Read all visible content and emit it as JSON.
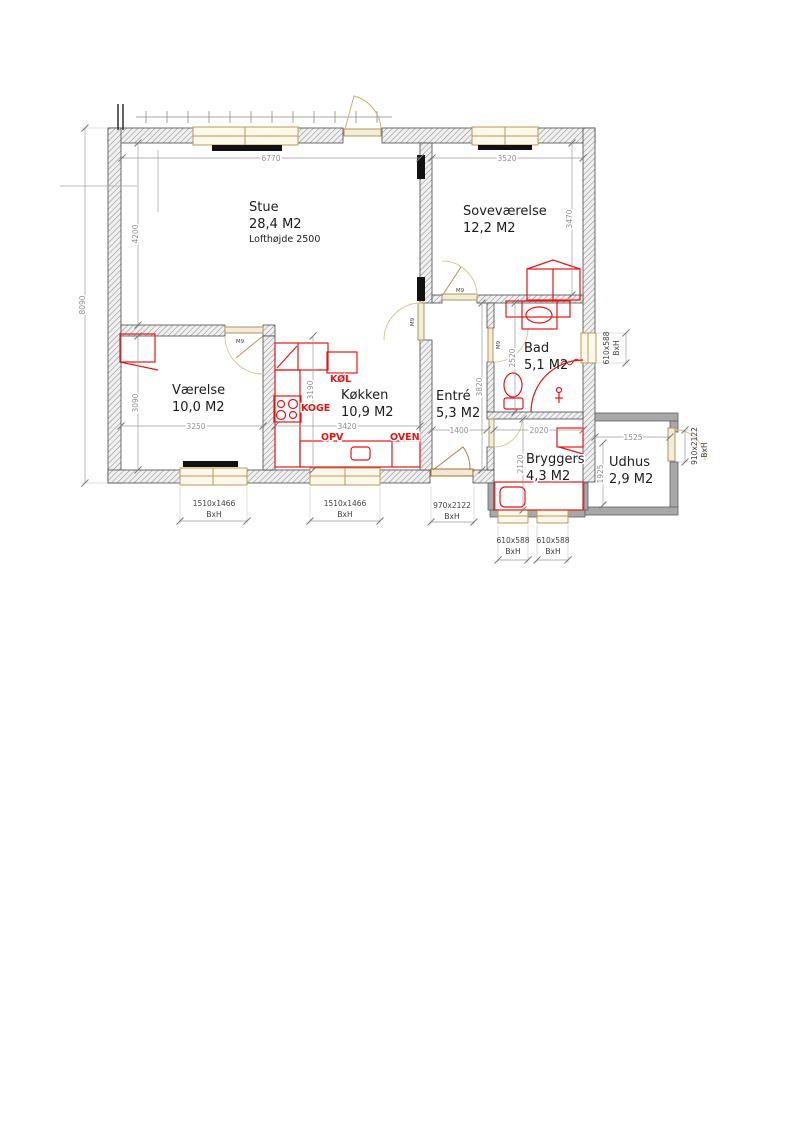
{
  "drawing": {
    "rooms": [
      {
        "name": "Stue",
        "area": "28,4 M2",
        "note": "Lofthøjde 2500"
      },
      {
        "name": "Soveværelse",
        "area": "12,2 M2"
      },
      {
        "name": "Værelse",
        "area": "10,0 M2"
      },
      {
        "name": "Køkken",
        "area": "10,9 M2"
      },
      {
        "name": "Entré",
        "area": "5,3 M2"
      },
      {
        "name": "Bad",
        "area": "5,1 M2"
      },
      {
        "name": "Bryggers",
        "area": "4,3 M2"
      },
      {
        "name": "Udhus",
        "area": "2,9 M2"
      }
    ],
    "kitchen_labels": {
      "fridge": "KØL",
      "hob": "KOGE",
      "dishwasher": "OPV",
      "oven": "OVEN"
    },
    "door_code": "M9",
    "dims": {
      "overall_height": "8090",
      "stue_width": "6770",
      "stue_height": "4200",
      "sove_width": "3520",
      "sove_height": "3470",
      "vaerelse_width": "3250",
      "vaerelse_height": "3090",
      "koekken_width": "3420",
      "koekken_height": "3190",
      "entre_width": "1400",
      "entre_height": "3820",
      "bad_height": "2520",
      "bryggers_width": "2020",
      "bryggers_height": "2120",
      "udhus_width": "1525",
      "udhus_height": "1925"
    },
    "openings": {
      "window_large": "1510x1466",
      "door_back": "970x2122",
      "window_small": "610x588",
      "door_shed": "910x2122",
      "bxh": "BxH"
    },
    "colors": {
      "fixture_red": "#e51515",
      "wall_hatch": "#8f8f8f",
      "wood": "#b2945e"
    }
  }
}
